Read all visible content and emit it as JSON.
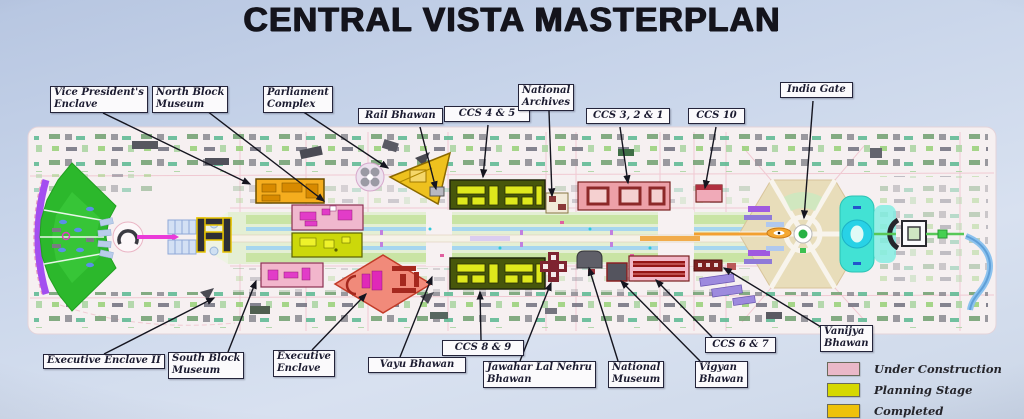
{
  "title": "CENTRAL VISTA MASTERPLAN",
  "labels": {
    "vice_presidents_enclave": "Vice President's\nEnclave",
    "north_block_museum": "North Block\nMuseum",
    "parliament_complex": "Parliament\nComplex",
    "rail_bhawan": "Rail Bhawan",
    "ccs_4_5": "CCS 4 & 5",
    "national_archives": "National\nArchives",
    "ccs_3_2_1": "CCS 3, 2 & 1",
    "ccs_10": "CCS 10",
    "india_gate": "India Gate",
    "executive_enclave_ii": "Executive Enclave II",
    "south_block_museum": "South Block\nMuseum",
    "executive_enclave": "Executive\nEnclave",
    "vayu_bhawan": "Vayu Bhawan",
    "ccs_8_9": "CCS 8 & 9",
    "jawahar_lal_nehru_bhawan": "Jawahar Lal Nehru\nBhawan",
    "national_museum": "National\nMuseum",
    "vigyan_bhawan": "Vigyan\nBhawan",
    "ccs_6_7": "CCS 6 & 7",
    "vanijya_bhawan": "Vanijya\nBhawan"
  },
  "legend": {
    "items": [
      {
        "label": "Under Construction",
        "color": "#eab8c8"
      },
      {
        "label": "Planning Stage",
        "color": "#d6d800"
      },
      {
        "label": "Completed",
        "color": "#eec20a"
      }
    ]
  }
}
